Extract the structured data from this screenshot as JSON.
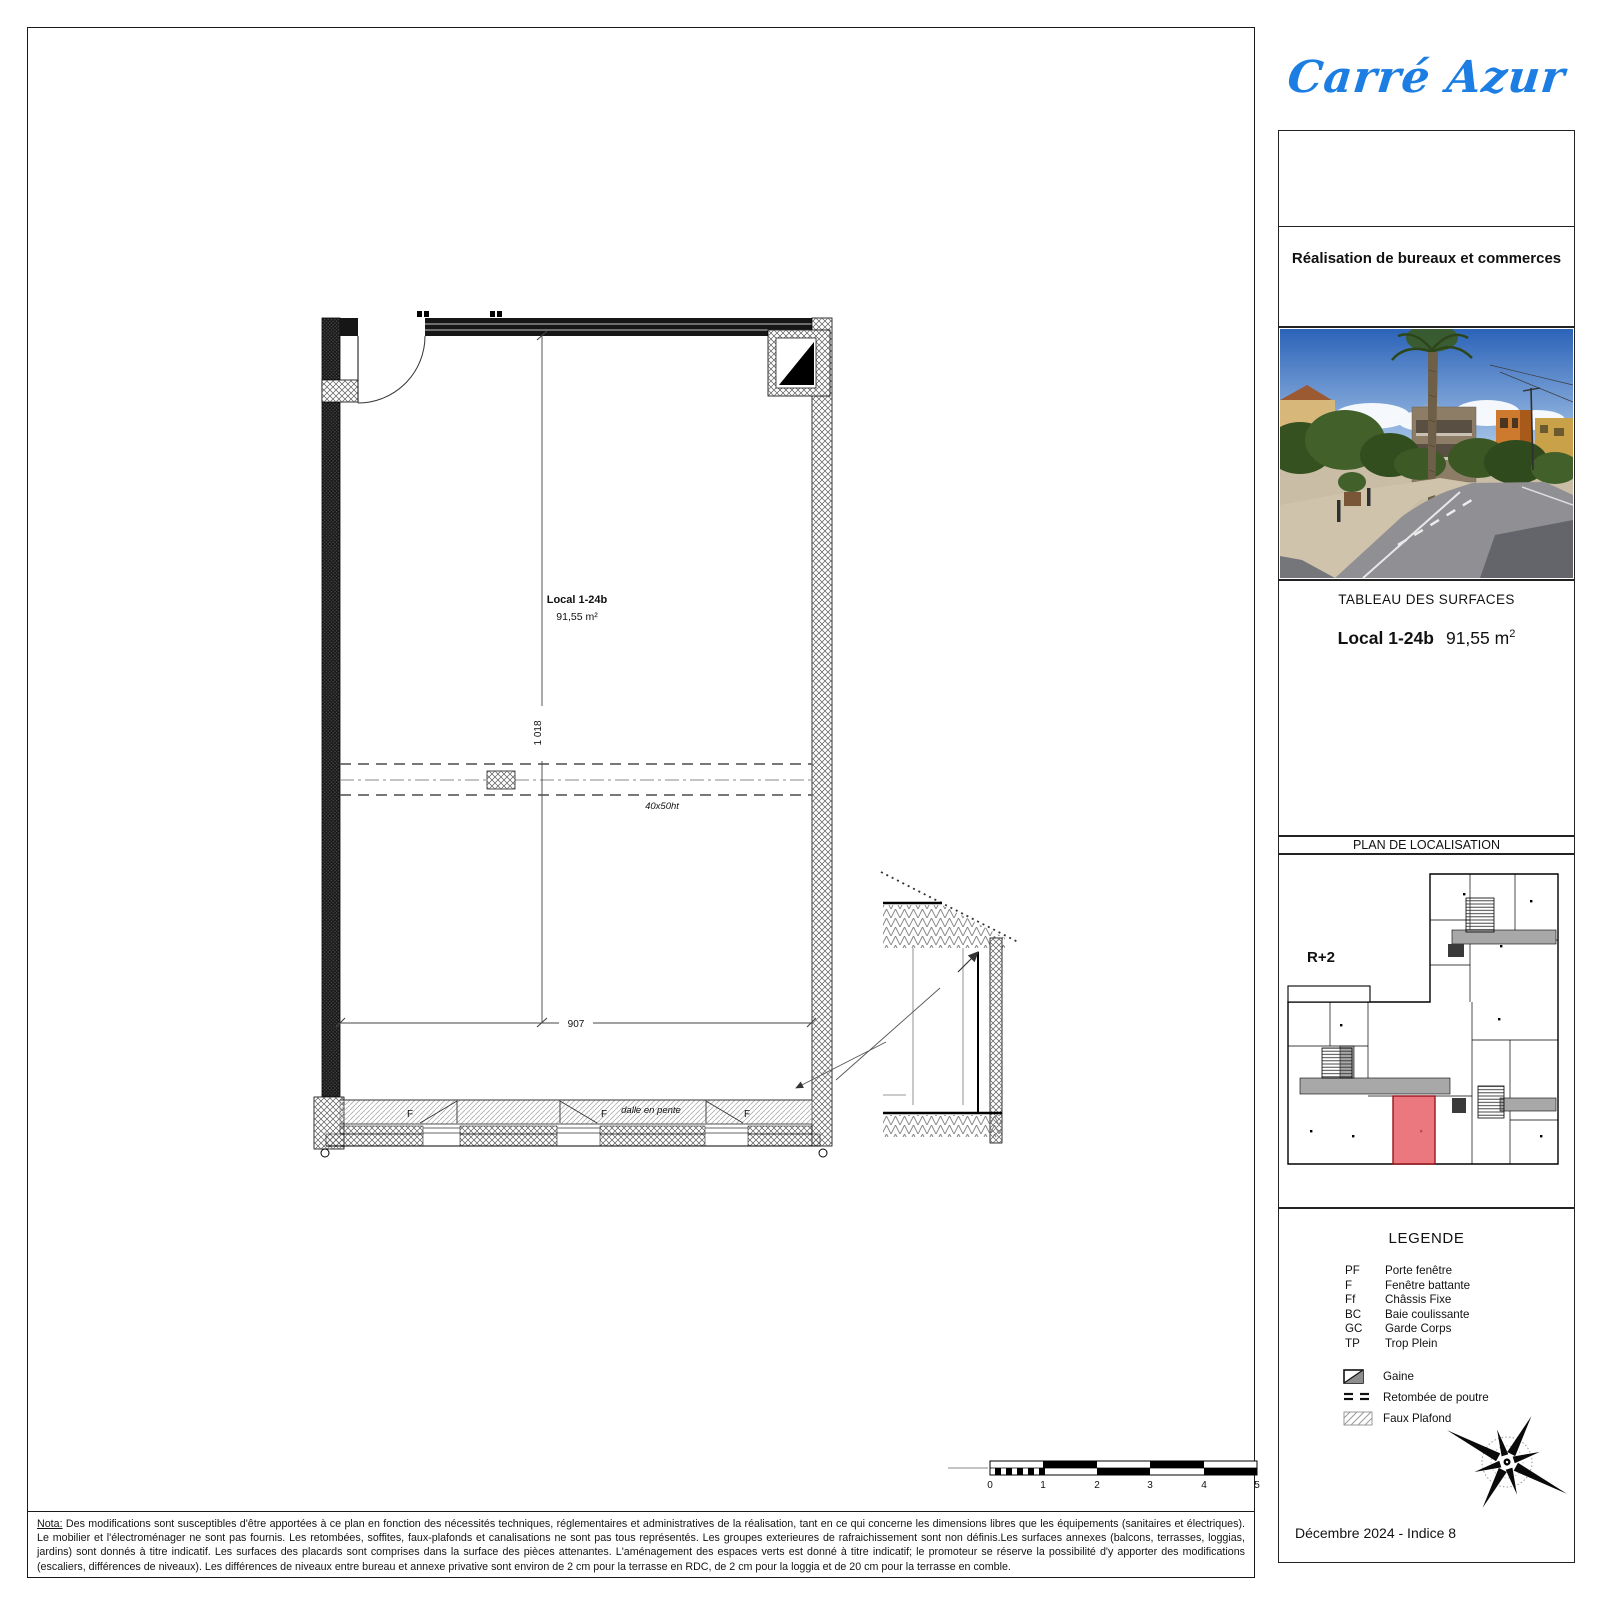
{
  "brand": {
    "logo_text": "Carré Azur",
    "logo_color": "#1c7ee3"
  },
  "titleblock": {
    "subtitle": "Réalisation de bureaux et commerces",
    "surfaces_title": "TABLEAU DES SURFACES",
    "unit_name": "Local 1-24b",
    "unit_area_value": "91,55 m",
    "unit_area_sup": "2",
    "localisation_title": "PLAN DE LOCALISATION",
    "date_line": "Décembre 2024 - Indice 8"
  },
  "localisation": {
    "floor_label": "R+2",
    "highlight_color": "#e65a62"
  },
  "legend": {
    "title": "LEGENDE",
    "abbreviations": [
      {
        "abbr": "PF",
        "label": "Porte fenêtre"
      },
      {
        "abbr": "F",
        "label": "Fenêtre battante"
      },
      {
        "abbr": "Ff",
        "label": "Châssis Fixe"
      },
      {
        "abbr": "BC",
        "label": "Baie coulissante"
      },
      {
        "abbr": "GC",
        "label": "Garde Corps"
      },
      {
        "abbr": "TP",
        "label": "Trop Plein"
      }
    ],
    "symbols": [
      {
        "name": "gaine",
        "label": "Gaine"
      },
      {
        "name": "retombee-de-poutre",
        "label": "Retombée de poutre"
      },
      {
        "name": "faux-plafond",
        "label": "Faux Plafond"
      }
    ]
  },
  "plan": {
    "room_label": "Local 1-24b",
    "room_area": "91,55 m²",
    "dim_vertical": "1 018",
    "dim_horizontal": "907",
    "beam_label": "40x50ht",
    "slab_label": "dalle en pente",
    "window_letter": "F"
  },
  "scalebar": {
    "ticks": [
      "0",
      "1",
      "2",
      "3",
      "4",
      "5"
    ]
  },
  "nota": {
    "label": "Nota:",
    "text": "Des modifications sont susceptibles d'être apportées à ce plan en fonction des nécessités techniques, réglementaires et administratives de la réalisation, tant en ce qui concerne les dimensions libres que les équipements (sanitaires et électriques). Le mobilier et l'électroménager ne sont pas fournis. Les retombées, soffites, faux-plafonds et canalisations ne sont pas tous représentés. Les groupes exterieures de rafraichissement sont non définis.Les surfaces annexes (balcons, terrasses, loggias, jardins) sont donnés à titre indicatif. Les surfaces des placards sont comprises dans la surface des pièces attenantes. L'aménagement des espaces verts est donné à titre indicatif; le promoteur se réserve la possibilité d'y apporter des modifications (escaliers, différences de niveaux). Les différences de niveaux entre bureau et annexe privative sont environ de 2 cm pour la terrasse en RDC, de 2 cm pour la loggia et de 20 cm pour la terrasse en comble."
  }
}
